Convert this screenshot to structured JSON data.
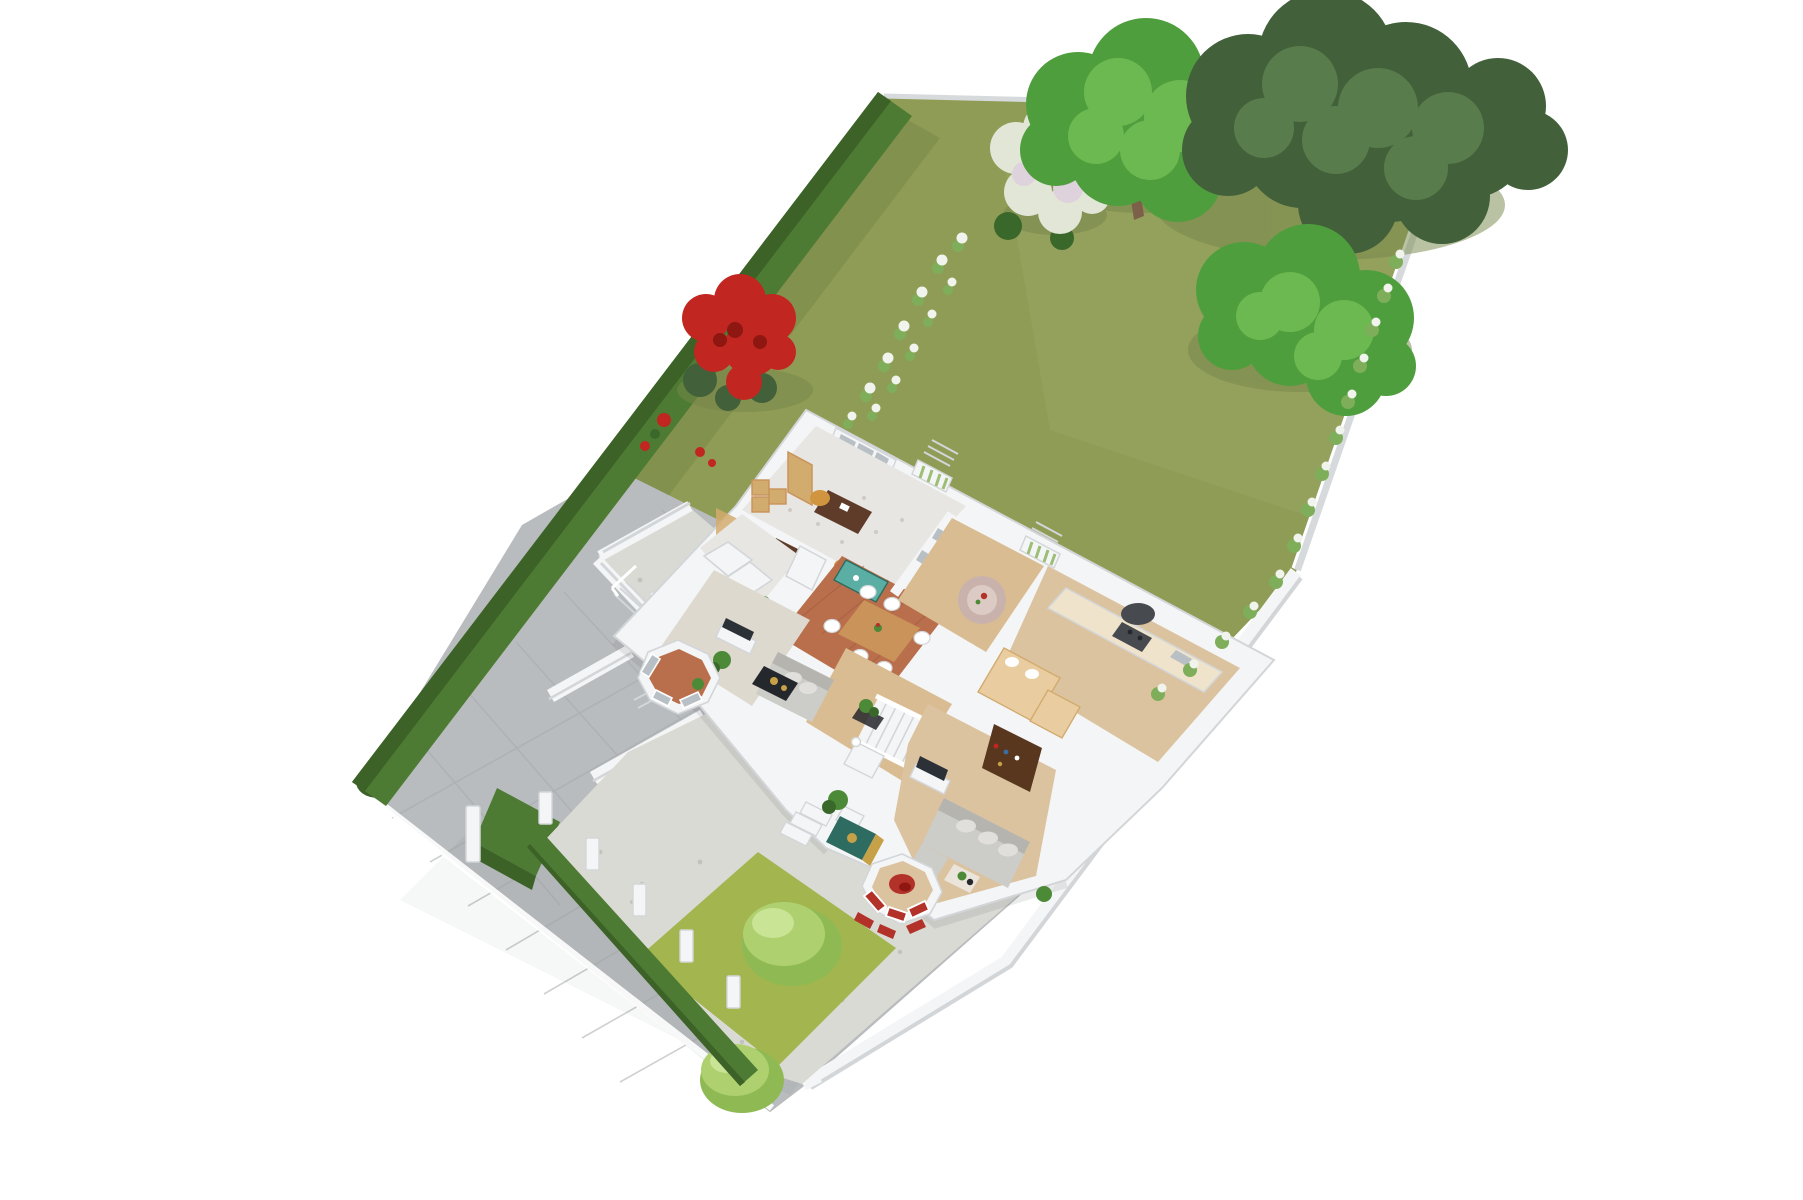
{
  "meta": {
    "description": "3D isometric cutaway floor plan render of a single family house on a long wedge-shaped garden plot, viewed from above on a white background",
    "visible_text": "none"
  },
  "palette": {
    "lawn": "#8f9c55",
    "lawnShade": "#76854a",
    "frontLawn": "#a2b54f",
    "bushLight": "#aed06f",
    "bushMid": "#8fba53",
    "bushHi": "#c8e494",
    "hedge": "#4e7b33",
    "hedgeDark": "#3c6227",
    "treeDark": "#42603a",
    "treeDarkHi": "#587c4b",
    "treeGreen": "#4f9e3d",
    "treeGreenHi": "#6cb951",
    "shrubWhite": "#e2e6d7",
    "shrubPink": "#ded2dd",
    "flowerWhite": "#f1f4ec",
    "sprigGreen": "#7fae5a",
    "rose": "#c22620",
    "roseDark": "#8f1712",
    "paving": "#b9bcbe",
    "pavingLine": "#a7aaad",
    "gravel": "#dadad4",
    "gravelDot": "#c2c3bc",
    "wall": "#f4f5f6",
    "wallShade": "#d3d6d9",
    "wallDark": "#c1c5c9",
    "fence": "#d7dadc",
    "floorSpeckle": "#e8e6e2",
    "speckleDot": "#cecbc5",
    "terra": "#b96f4c",
    "terraDark": "#a05a3c",
    "wood": "#dcc3a0",
    "woodHall": "#d9bc92",
    "livingFloor": "#ded9cf",
    "woodMid": "#c9935a",
    "woodTan": "#d2ab6e",
    "cream": "#efe4cb",
    "deskBrown": "#5f3c2a",
    "walnut": "#59371f",
    "chairTan": "#d1953f",
    "sofa": "#ccccc8",
    "sofaDark": "#b5b4af",
    "cushion": "#e0dfdb",
    "tv": "#2c3137",
    "black": "#24272b",
    "teal": "#5aaea4",
    "doorTeal": "#2e6b60",
    "gold": "#c7a148",
    "red": "#b23129",
    "plant": "#4d8a38",
    "plantDark": "#39682a",
    "rug": "#c9b2ac",
    "rugLight": "#dccac4",
    "stove": "#474b50",
    "pane": "#b9c0c5",
    "banquette": "#e9cda1",
    "slat": "#9dbe74",
    "trunk": "#7d6049"
  },
  "scene": {
    "type": "isometric-3d-floor-plan",
    "plot_features": [
      "back-garden-lawn",
      "top-left-boundary-hedge",
      "top-boundary-fence",
      "right-boundary-wall",
      "flower-border",
      "driveway-block-paving",
      "front-garden-gravel",
      "front-lawn",
      "front-boundary-hedge-with-posts",
      "boxwood-cube",
      "sunken-patio"
    ],
    "house_rooms": [
      "home-office",
      "study",
      "living-room",
      "dining-area",
      "rear-hallway",
      "kitchen",
      "stair-hall",
      "family-room",
      "entrance-porch",
      "bay-window-living",
      "bay-window-family"
    ],
    "planting": [
      "large-oak-tree",
      "green-garden-tree",
      "garden-shrub",
      "white-flowering-shrub",
      "red-rose-bush",
      "front-lawn-bushes"
    ],
    "furniture": {
      "home-office": [
        "two-desks-with-chairs",
        "cube-shelves",
        "tall-cabinet"
      ],
      "dining-area": [
        "wood-dining-table",
        "white-chairs",
        "teal-sideboard",
        "fridge"
      ],
      "kitchen": [
        "cream-cabinets",
        "range-cooker-with-hood",
        "tan-banquette"
      ],
      "living-room": [
        "gray-sofa",
        "tv-console",
        "black-coffee-table",
        "plants"
      ],
      "family-room": [
        "gray-sectional-sofa",
        "tv-console",
        "walnut-bookcase",
        "red-armchair"
      ],
      "rear-hallway": [
        "round-pink-rug"
      ],
      "stair-hall": [
        "white-staircase",
        "planter-box"
      ],
      "sunken-patio": [
        "wood-table",
        "bench",
        "ladder-shelf"
      ]
    }
  }
}
